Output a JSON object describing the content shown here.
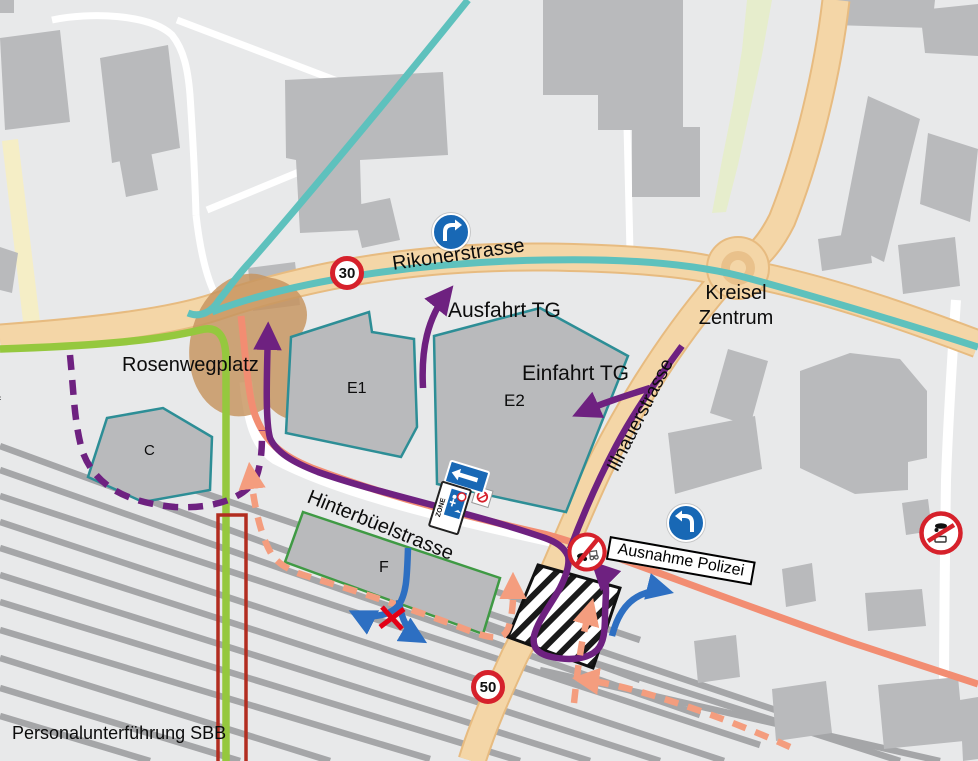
{
  "labels": {
    "rikonerstrasse": "Rikonerstrasse",
    "ausfahrt_tg": "Ausfahrt TG",
    "einfahrt_tg": "Einfahrt TG",
    "kreisel_zentrum": [
      "Kreisel",
      "Zentrum"
    ],
    "rosenwegplatz": "Rosenwegplatz",
    "hinterbuelstrasse": "Hinterbüelstrasse",
    "illnauerstrasse": "Illnauerstrasse",
    "ausnahme_polizei": "Ausnahme Polizei",
    "personalunterfuehrung_sbb": "Personalunterführung SBB",
    "building_e1": "E1",
    "building_e2": "E2",
    "building_c": "C",
    "building_f": "F",
    "edge_fragment": "f"
  },
  "signs": {
    "speed_limit_30": "30",
    "speed_limit_50": "50",
    "zone_label": "ZONE"
  },
  "colors": {
    "background": "#e8e9ea",
    "building": "#b9babc",
    "railway": "#a5a6a8",
    "road_fill": "#f4d6a7",
    "road_border": "#e7bb80",
    "path_yellow": "#f5eec6",
    "green_strip": "#e6edcc",
    "route_teal": "#5ec1bd",
    "route_green": "#95c83e",
    "route_purple": "#6e2180",
    "route_salmon": "#f28d72",
    "route_orange_dashed": "#f49d7e",
    "arrow_blue": "#2d6fc2",
    "sign_blue": "#1868b5",
    "sign_red": "#d6212b",
    "red_x": "#e30016",
    "underpass_red": "#b22d20",
    "plaza_brown": "#c7945f",
    "outline_teal": "#2d8e96",
    "outline_green": "#3f9a44"
  }
}
